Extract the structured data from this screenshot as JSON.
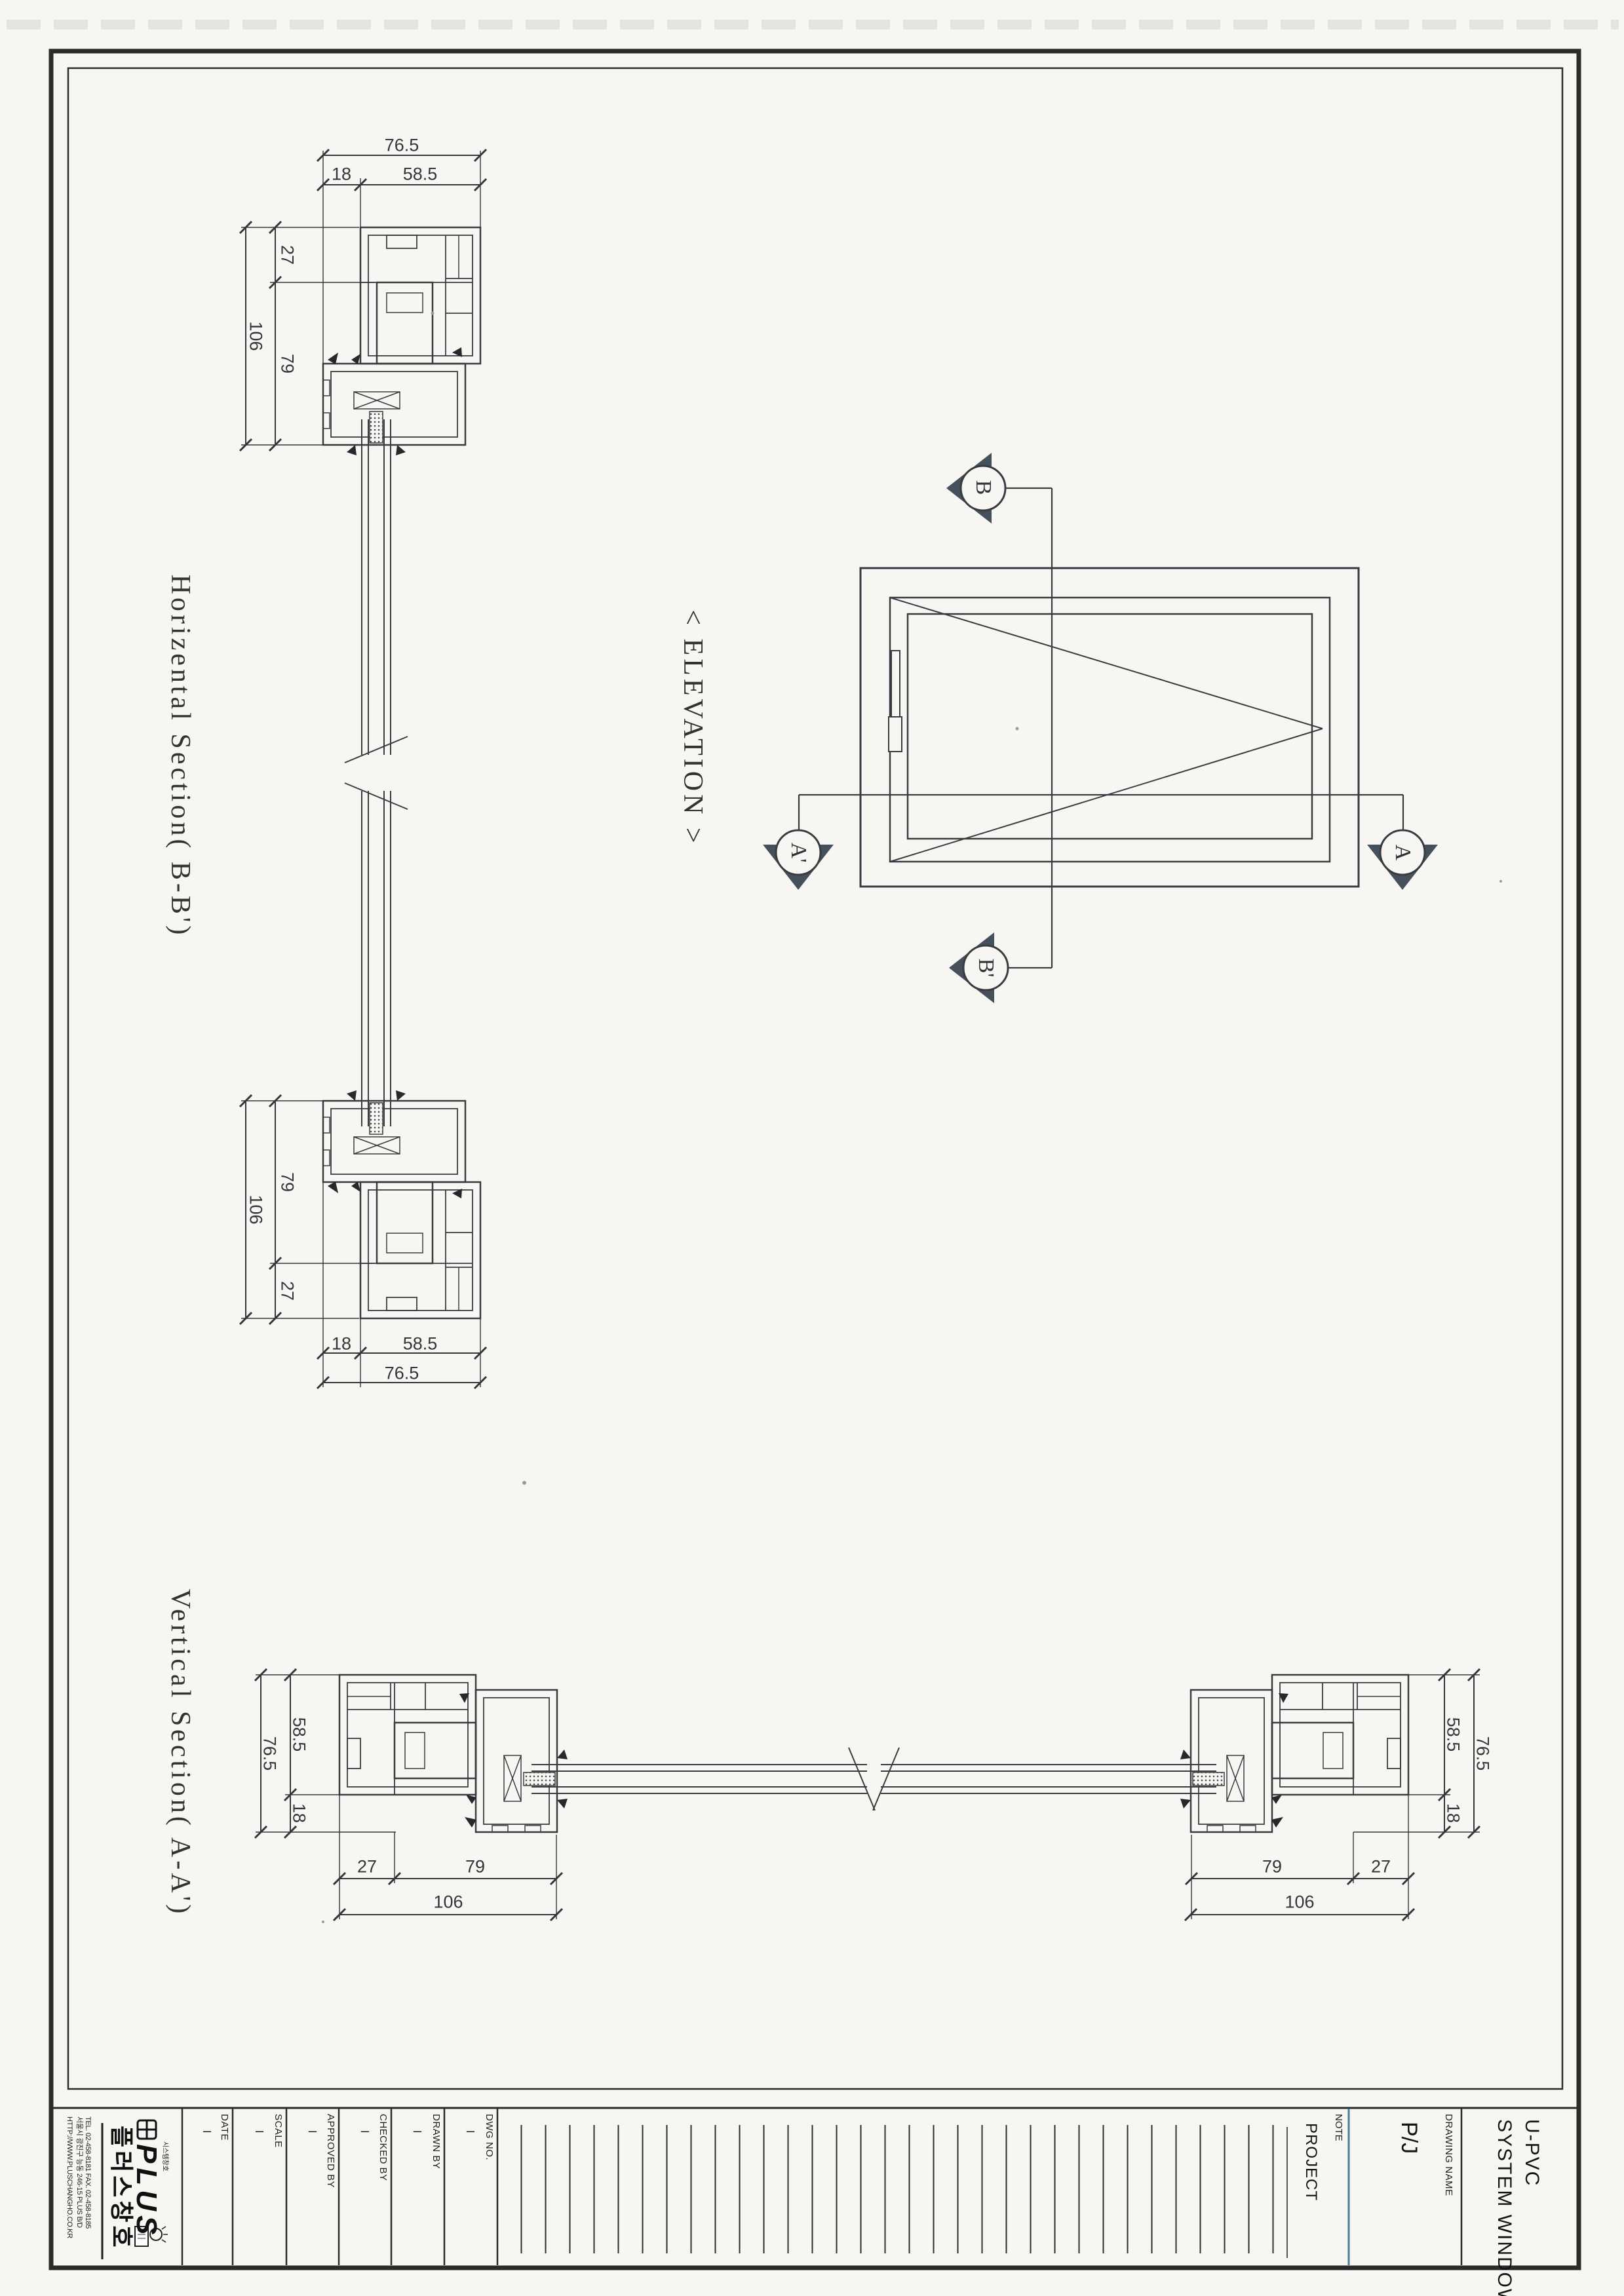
{
  "sections": {
    "horizontal_title": "Horizental Section( B-B')",
    "vertical_title": "Vertical Section( A-A')",
    "elevation_title": "< ELEVATION >"
  },
  "markers": {
    "b": "B",
    "b_prime": "B'",
    "a_prime": "A'",
    "a": "A"
  },
  "dims": {
    "d765": "76.5",
    "d18": "18",
    "d585": "58.5",
    "d27": "27",
    "d106": "106",
    "d79": "79"
  },
  "titleblock": {
    "fields": [
      {
        "label": "DATE",
        "value": "–"
      },
      {
        "label": "SCALE",
        "value": "–"
      },
      {
        "label": "APPROVED BY",
        "value": "–"
      },
      {
        "label": "CHECKED BY",
        "value": "–"
      },
      {
        "label": "DRAWN BY",
        "value": "–"
      },
      {
        "label": "DWG NO.",
        "value": "–"
      }
    ],
    "note_label": "NOTE",
    "project_label": "PROJECT",
    "drawing_name_label": "DRAWING NAME",
    "drawing_name_value": "P/J",
    "product_line1": "U-PVC",
    "product_line2": "SYSTEM WINDOWS",
    "company": {
      "logo_text": "PLUS",
      "logo_sub": "시스템창호",
      "name_kr": "플러스창호",
      "tel": "TEL. 02-458-8181  FAX. 02-458-8185",
      "address": "서울시 광진구 능동 246-15 PLUS B/D",
      "website": "HTTP://WWW.PLUSCHANGHO.CO.KR"
    }
  }
}
